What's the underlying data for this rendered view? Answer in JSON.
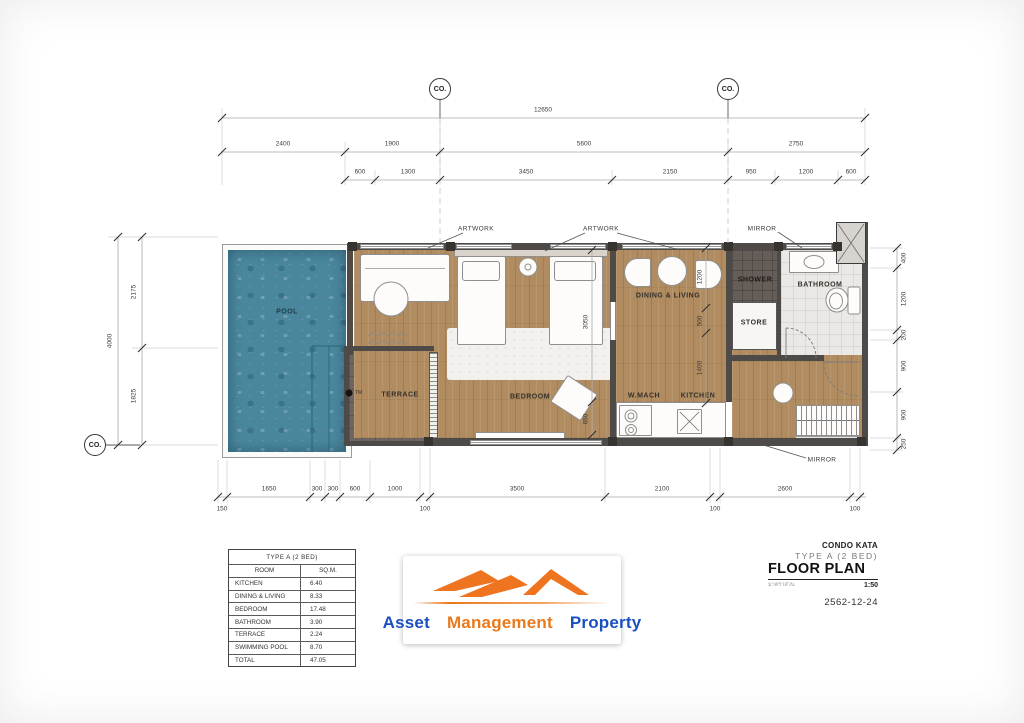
{
  "markers": {
    "grid_bubble": "CO."
  },
  "dims": {
    "overall_width": "12650",
    "top_row2": [
      "2400",
      "1900",
      "5600",
      "2750"
    ],
    "top_row3": [
      "600",
      "1300",
      "3450",
      "2150",
      "950",
      "1200",
      "600"
    ],
    "left_outer": "4000",
    "left_inner": [
      "2175",
      "1825"
    ],
    "right": [
      "400",
      "1200",
      "200",
      "900",
      "900",
      "250"
    ],
    "bottom": [
      "1650",
      "300",
      "300",
      "600",
      "1000",
      "3500",
      "2100",
      "2600"
    ],
    "bottom_offsets": [
      "150",
      "100",
      "100",
      "100"
    ],
    "bedroom_chain": [
      "3050",
      "650"
    ],
    "dining_chain": [
      "1200",
      "500",
      "1400"
    ]
  },
  "rooms": {
    "pool": "POOL",
    "terrace": "TERRACE",
    "bedroom": "BEDROOM",
    "dining_living": "DINING & LIVING",
    "w_mach": "W.MACH",
    "kitchen": "KITCHEN",
    "shower": "SHOWER",
    "store": "STORE",
    "bathroom": "BATHROOM"
  },
  "annotations": {
    "artwork": "ARTWORK",
    "mirror": "MIRROR",
    "pool_note": "TM"
  },
  "area_table": {
    "title": "TYPE A (2 BED)",
    "columns": [
      "ROOM",
      "SQ.M."
    ],
    "rows": [
      [
        "KITCHEN",
        "6.40"
      ],
      [
        "DINING & LIVING",
        "8.33"
      ],
      [
        "BEDROOM",
        "17.48"
      ],
      [
        "BATHROOM",
        "3.90"
      ],
      [
        "TERRACE",
        "2.24"
      ],
      [
        "SWIMMING POOL",
        "8.70"
      ],
      [
        "TOTAL",
        "47.05"
      ]
    ]
  },
  "title_block": {
    "project": "CONDO KATA",
    "unit": "TYPE A (2 BED)",
    "drawing": "FLOOR PLAN",
    "scale_label": "มาตราส่วน",
    "scale": "1:50",
    "date": "2562-12-24"
  },
  "logo": {
    "words": [
      {
        "text": "Asset",
        "color": "#1b50c0"
      },
      {
        "text": "Management",
        "color": "#e8791d"
      },
      {
        "text": "Property",
        "color": "#1b50c0"
      }
    ],
    "accent_orange": "#ef7420"
  }
}
